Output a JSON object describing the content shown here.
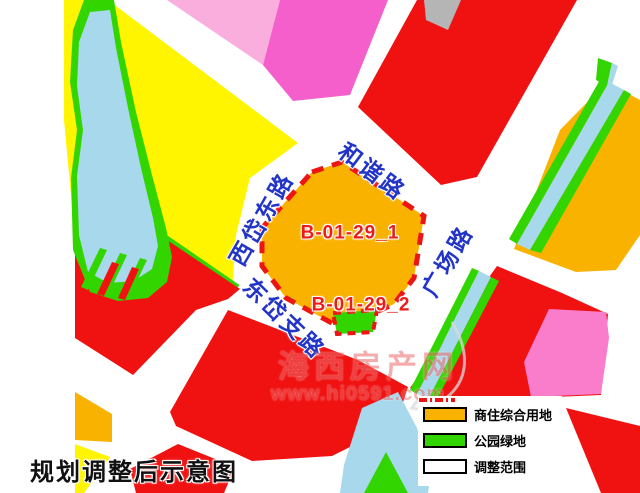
{
  "colors": {
    "yellow": "#FFF500",
    "green": "#33D500",
    "water_blue": "#A8D8EB",
    "red": "#F01111",
    "orange": "#F9B200",
    "light_pink": "#F9AEDE",
    "magenta": "#F55FCB",
    "pink": "#FA7DCB",
    "gray": "#B5B5B5",
    "boundary_red": "#ED1414",
    "road_label_blue": "#2335C8",
    "parcel_label_red": "#ED1C1C",
    "title_black": "#111111",
    "watermark_red": "#EE6A6A"
  },
  "map": {
    "parcels": {
      "parcel_1": "B-01-29_1",
      "parcel_2": "B-01-29_2"
    },
    "roads": {
      "north": "和谐路",
      "west": "西岱东路",
      "southwest": "东岱支路",
      "east": "广场路"
    }
  },
  "legend": {
    "items": [
      {
        "label": "商住综合用地",
        "swatch": "orange"
      },
      {
        "label": "公园绿地",
        "swatch": "green"
      },
      {
        "label": "调整范围",
        "swatch": "dash-line"
      }
    ]
  },
  "title": "规划调整后示意图",
  "watermark": {
    "site_name": "海西房产网",
    "url": "www.hi0591.com"
  }
}
